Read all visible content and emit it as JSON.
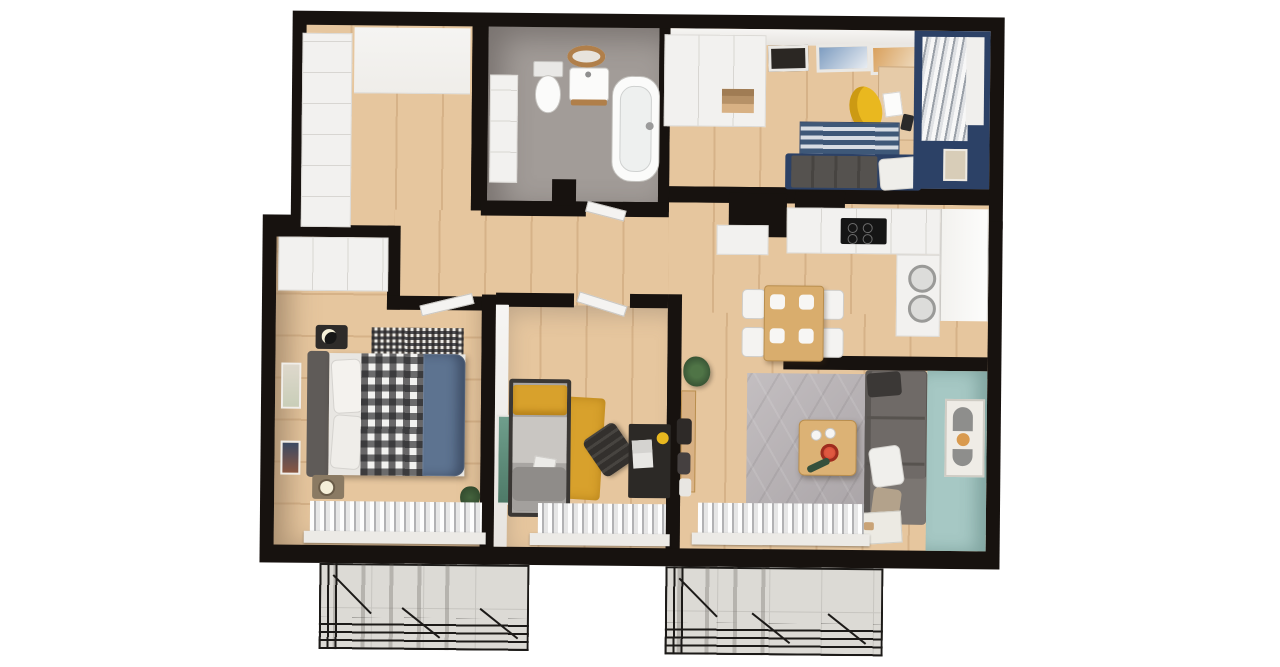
{
  "title": "3D apartment floor plan render",
  "palette": {
    "wall": "#17120f",
    "wood": "#e6c69e",
    "woodline": "#d6b288",
    "tile": "#a29c98",
    "white": "#f2f1ef",
    "beige": "#b5a898",
    "navy": "#2c4166",
    "teal": "#a6c8c4",
    "ruggray": "#b6b0b3",
    "mustard": "#d8a12c",
    "sofagray": "#6f6a67",
    "duvet": "#5d7390",
    "balcony": "#dcdad5",
    "red": "#c23b28",
    "plant": "#3f5e3a",
    "yellow": "#e9b81f",
    "tablewood": "#d9ad6d"
  },
  "rooms": {
    "entry_hall": {
      "name": "Entry hall",
      "furniture": [
        "built-in wardrobe",
        "entry zone"
      ]
    },
    "bathroom": {
      "name": "Bathroom",
      "furniture": [
        "toilet",
        "vanity with round mirror",
        "freestanding bathtub",
        "storage cabinet"
      ]
    },
    "bedroom_office": {
      "name": "Bedroom / office",
      "furniture": [
        "wardrobe",
        "three gallery frames",
        "desk",
        "yellow chair",
        "blue striped rug",
        "gray daybed with pillow",
        "navy accent wall",
        "window curtain",
        "wall frame"
      ]
    },
    "kitchen": {
      "name": "Kitchen",
      "furniture": [
        "white counter with cooktop",
        "washer",
        "dryer",
        "window"
      ]
    },
    "dining_area": {
      "name": "Dining area",
      "furniture": [
        "wooden table",
        "four white chairs",
        "place settings",
        "pendant light"
      ]
    },
    "hallway": {
      "name": "Hallway",
      "furniture": [
        "potted plant",
        "coat rack"
      ]
    },
    "master_bedroom": {
      "name": "Master bedroom",
      "furniture": [
        "wardrobe",
        "double bed",
        "plaid blanket",
        "navy duvet",
        "checkered rug",
        "two nightstands with lamps",
        "wall art",
        "window curtain"
      ]
    },
    "kids_room": {
      "name": "Kids room",
      "furniture": [
        "single bed",
        "mustard pillow",
        "mustard throw rug",
        "black desk with laptop",
        "desk chair",
        "green artwork",
        "window curtain"
      ]
    },
    "living_room": {
      "name": "Living room",
      "furniture": [
        "gray hex-pattern rug",
        "coffee table with red bowl",
        "gray corner sofa",
        "white pillow",
        "teal accent wall",
        "abstract poster",
        "doormat",
        "window curtain"
      ]
    },
    "balcony_left": {
      "name": "Balcony (left)",
      "furniture": [
        "concrete tile floor",
        "black metal railing"
      ]
    },
    "balcony_right": {
      "name": "Balcony (right)",
      "furniture": [
        "concrete tile floor",
        "black metal railing"
      ]
    }
  }
}
